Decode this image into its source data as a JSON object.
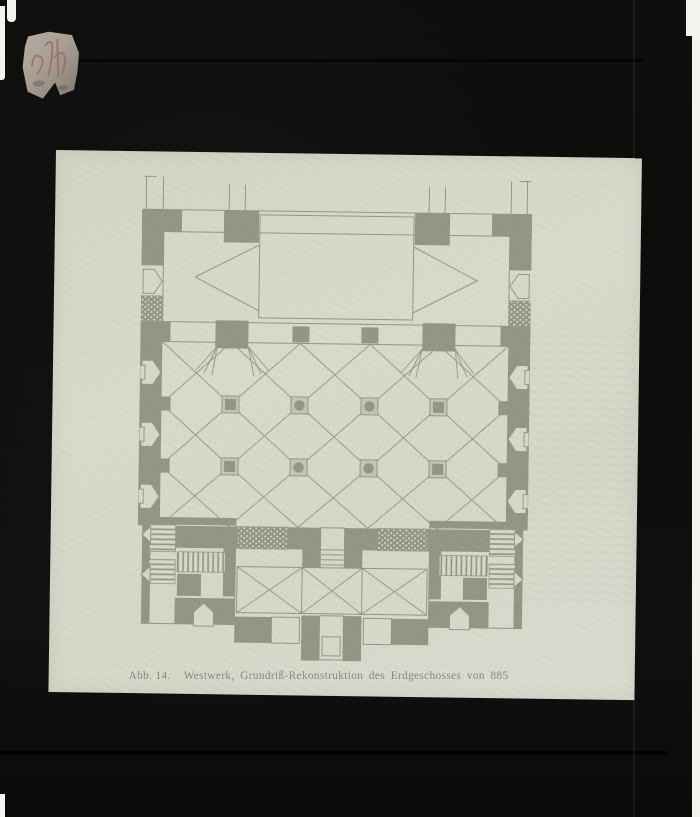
{
  "figure": {
    "caption_label": "Abb. 14.",
    "caption_text": "Westwerk, Grundriß-Rekonstruktion des Erdgeschosses von 885"
  },
  "slide": {
    "medium": "glass lantern slide",
    "label_sticker": {
      "text": ""
    }
  },
  "colors": {
    "mount": "#0d0d0b",
    "photo": "#d6d8ca",
    "ink": "#8f917e",
    "ink-text": "#83867a",
    "pier-light": "#c2c4b2",
    "sticker": "#a59c91",
    "scribble": "#96625f",
    "paper": "#f4f3ef"
  }
}
